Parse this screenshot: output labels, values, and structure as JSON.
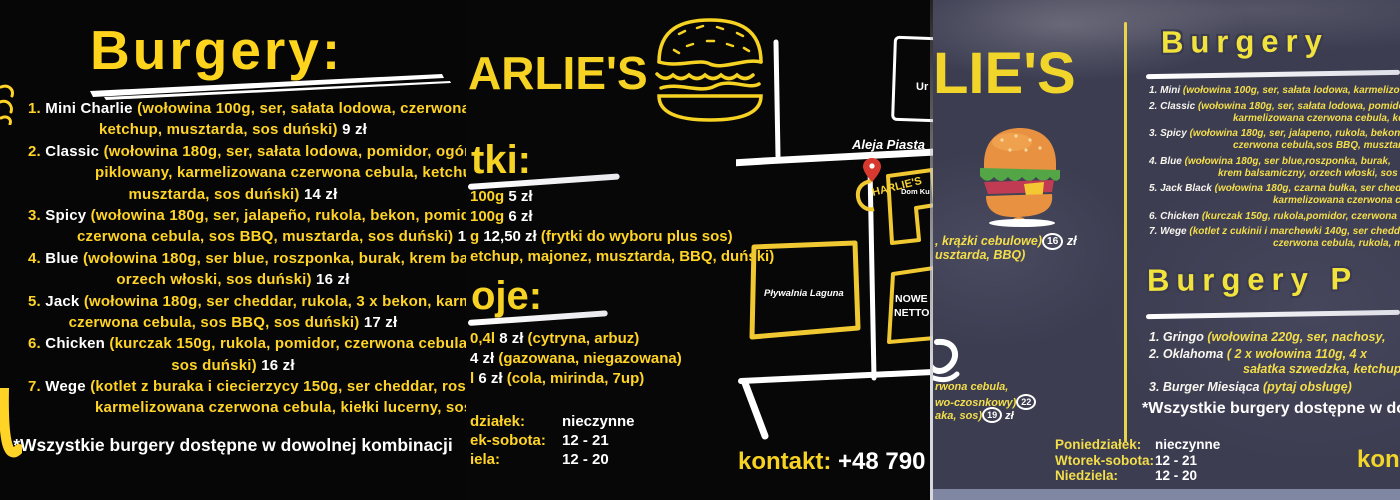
{
  "colors": {
    "yellow": "#ffd426",
    "yellow_soft": "#f3de4a",
    "white": "#ffffff",
    "black_bg": "#070707",
    "board_bg": "#3d3d52",
    "pin_red": "#d8392e"
  },
  "panel_left": {
    "title": "Burgery:",
    "lines": [
      {
        "cls": "start",
        "parts": [
          {
            "t": "1. ",
            "c": "n"
          },
          {
            "t": "Mini Charlie ",
            "c": "nm"
          },
          {
            "t": "(wołowina 100g, ser, sałata lodowa, czerwona",
            "c": "d"
          }
        ]
      },
      {
        "cls": "ctr",
        "parts": [
          {
            "t": "ketchup, musztarda, sos duński) ",
            "c": "d"
          },
          {
            "t": "9 zł",
            "c": "p"
          }
        ]
      },
      {
        "cls": "start",
        "parts": [
          {
            "t": "2. ",
            "c": "n"
          },
          {
            "t": "Classic ",
            "c": "nm"
          },
          {
            "t": "(wołowina  180g, ser, sałata lodowa, pomidor, ogórek",
            "c": "d"
          }
        ]
      },
      {
        "cls": "wrap",
        "parts": [
          {
            "t": "piklowany, karmelizowana czerwona cebula, ketchup,",
            "c": "d"
          }
        ]
      },
      {
        "cls": "ctr",
        "parts": [
          {
            "t": "musztarda, sos duński) ",
            "c": "d"
          },
          {
            "t": "14 zł",
            "c": "p"
          }
        ]
      },
      {
        "cls": "start",
        "parts": [
          {
            "t": "3. ",
            "c": "n"
          },
          {
            "t": "Spicy ",
            "c": "nm"
          },
          {
            "t": "(wołowina 180g, ser, jalapeño, rukola, bekon, pomidor,",
            "c": "d"
          }
        ]
      },
      {
        "cls": "wrap2",
        "parts": [
          {
            "t": "czerwona cebula, sos BBQ, musztarda, sos duński) ",
            "c": "d"
          },
          {
            "t": "1",
            "c": "p"
          }
        ]
      },
      {
        "cls": "start",
        "parts": [
          {
            "t": "4. ",
            "c": "n"
          },
          {
            "t": "Blue ",
            "c": "nm"
          },
          {
            "t": "(wołowina 180g, ser blue, roszponka, burak, krem balsamiczny,",
            "c": "d"
          }
        ]
      },
      {
        "cls": "ctr",
        "parts": [
          {
            "t": "orzech włoski, sos duński) ",
            "c": "d"
          },
          {
            "t": "16 zł",
            "c": "p"
          }
        ]
      },
      {
        "cls": "start",
        "parts": [
          {
            "t": "5. ",
            "c": "n"
          },
          {
            "t": "Jack ",
            "c": "nm"
          },
          {
            "t": "(wołowina 180g, ser cheddar, rukola, 3 x bekon, karmelizowana",
            "c": "d"
          }
        ]
      },
      {
        "cls": "ctr",
        "parts": [
          {
            "t": "czerwona cebula, sos BBQ, sos duński) ",
            "c": "d"
          },
          {
            "t": "17 zł",
            "c": "p"
          }
        ]
      },
      {
        "cls": "start",
        "parts": [
          {
            "t": "6. ",
            "c": "n"
          },
          {
            "t": "Chicken ",
            "c": "nm"
          },
          {
            "t": "(kurczak 150g, rukola, pomidor, czerwona cebula,",
            "c": "d"
          }
        ]
      },
      {
        "cls": "ctr",
        "parts": [
          {
            "t": "sos duński) ",
            "c": "d"
          },
          {
            "t": "16 zł",
            "c": "p"
          }
        ]
      },
      {
        "cls": "start",
        "parts": [
          {
            "t": "7. ",
            "c": "n"
          },
          {
            "t": "Wege ",
            "c": "nm"
          },
          {
            "t": "(kotlet z buraka i ciecierzycy 150g, ser cheddar, roszponka,",
            "c": "d"
          }
        ]
      },
      {
        "cls": "wrap",
        "parts": [
          {
            "t": "karmelizowana czerwona cebula, kiełki lucerny, sos duński)",
            "c": "d"
          }
        ]
      }
    ],
    "footer": "*Wszystkie burgery dostępne w dowolnej kombinacji"
  },
  "panel_middle": {
    "logo": "ARLIE'S",
    "fries_title": "tki:",
    "fries_lines": [
      {
        "cls": "edge",
        "parts": [
          {
            "t": "100g ",
            "c": "d"
          },
          {
            "t": "5 zł",
            "c": "p"
          }
        ]
      },
      {
        "cls": "edge",
        "parts": [
          {
            "t": "100g ",
            "c": "d"
          },
          {
            "t": "6 zł",
            "c": "p"
          }
        ]
      },
      {
        "cls": "edge",
        "parts": [
          {
            "t": "g ",
            "c": "d"
          },
          {
            "t": "12,50 zł ",
            "c": "p"
          },
          {
            "t": "(frytki do wyboru plus sos)",
            "c": "d"
          }
        ]
      },
      {
        "cls": "edge",
        "parts": [
          {
            "t": "etchup, majonez, musztarda, BBQ, duński)",
            "c": "d"
          }
        ]
      }
    ],
    "drinks_title": "oje:",
    "drinks_lines": [
      {
        "cls": "edge",
        "parts": [
          {
            "t": "0,4l ",
            "c": "d"
          },
          {
            "t": "8 zł ",
            "c": "p"
          },
          {
            "t": "(cytryna, arbuz)",
            "c": "d"
          }
        ]
      },
      {
        "cls": "edge",
        "parts": [
          {
            "t": "4 zł ",
            "c": "p"
          },
          {
            "t": "(gazowana, niegazowana)",
            "c": "d"
          }
        ]
      },
      {
        "cls": "edge",
        "parts": [
          {
            "t": "l ",
            "c": "d"
          },
          {
            "t": "6 zł ",
            "c": "p"
          },
          {
            "t": "(cola, mirinda, 7up)",
            "c": "d"
          }
        ]
      }
    ],
    "hours_lines": [
      {
        "cls": "edge",
        "parts": [
          {
            "t": "działek:",
            "c": "hl"
          },
          {
            "t": "nieczynne",
            "c": "hv"
          }
        ]
      },
      {
        "cls": "edge",
        "parts": [
          {
            "t": "ek-sobota:",
            "c": "hl"
          },
          {
            "t": "12 - 21",
            "c": "hv"
          }
        ]
      },
      {
        "cls": "edge",
        "parts": [
          {
            "t": "iela:",
            "c": "hl"
          },
          {
            "t": "12 - 20",
            "c": "hv"
          }
        ]
      }
    ],
    "contact_label": "kontakt: ",
    "contact_number": "+48 790",
    "map": {
      "street": "Aleja Piasta",
      "building_top": "Ur",
      "marker_label": "HARLIE'S",
      "building_dom": "Dom Ku",
      "building_pool": "Pływalnia Laguna",
      "building_netto_1": "NOWE",
      "building_netto_2": "NETTO"
    }
  },
  "panel_right": {
    "logo": "LIE'S",
    "left_lines_1": [
      {
        "cls": "edge",
        "parts": [
          {
            "t": ", krążki cebulowe)",
            "c": "d"
          },
          {
            "t": "16",
            "c": "circ"
          },
          {
            "t": " zł",
            "c": "w"
          }
        ]
      },
      {
        "cls": "edge",
        "parts": [
          {
            "t": "usztarda, BBQ)",
            "c": "d"
          }
        ]
      }
    ],
    "left_lines_2": [
      {
        "cls": "edge",
        "parts": [
          {
            "t": "rwona cebula,",
            "c": "d"
          }
        ]
      },
      {
        "cls": "edge",
        "parts": [
          {
            "t": "wo-czosnkowy)",
            "c": "d"
          },
          {
            "t": "22",
            "c": "circ"
          }
        ]
      },
      {
        "cls": "edge",
        "parts": [
          {
            "t": "aka, sos)",
            "c": "d"
          },
          {
            "t": "19",
            "c": "circ"
          },
          {
            "t": " zł",
            "c": "w"
          }
        ]
      }
    ],
    "section1_title": "Burgery",
    "section1_lines": [
      {
        "cls": "start",
        "parts": [
          {
            "t": "1. ",
            "c": "n"
          },
          {
            "t": "Mini ",
            "c": "nm"
          },
          {
            "t": "(wołowina 100g, ser, sałata lodowa, karmelizowana",
            "c": "d"
          }
        ]
      },
      {
        "cls": "start",
        "parts": [
          {
            "t": "2. ",
            "c": "n"
          },
          {
            "t": "Classic ",
            "c": "nm"
          },
          {
            "t": "(wołowina 180g, ser, sałata lodowa, pomidor,",
            "c": "d"
          }
        ]
      },
      {
        "cls": "wrap",
        "parts": [
          {
            "t": "karmelizowana czerwona cebula, ketchup,",
            "c": "d"
          }
        ]
      },
      {
        "cls": "start",
        "parts": [
          {
            "t": "3. ",
            "c": "n"
          },
          {
            "t": "Spicy ",
            "c": "nm"
          },
          {
            "t": "(wołowina 180g, ser, jalapeno, rukola, bekon,",
            "c": "d"
          }
        ]
      },
      {
        "cls": "wrap",
        "parts": [
          {
            "t": "czerwona cebula,sos BBQ, musztarda,",
            "c": "d"
          }
        ]
      },
      {
        "cls": "start",
        "parts": [
          {
            "t": "4. ",
            "c": "n"
          },
          {
            "t": "Blue ",
            "c": "nm"
          },
          {
            "t": "(wołowina 180g, ser blue,roszponka, burak,",
            "c": "d"
          }
        ]
      },
      {
        "cls": "wrap3",
        "parts": [
          {
            "t": "krem balsamiczny, orzech włoski, sos duński)",
            "c": "d"
          }
        ]
      },
      {
        "cls": "start",
        "parts": [
          {
            "t": "5. ",
            "c": "n"
          },
          {
            "t": "Jack Black ",
            "c": "nm"
          },
          {
            "t": "(wołowina 180g, czarna bułka, ser cheddar,",
            "c": "d"
          }
        ]
      },
      {
        "cls": "wrap4",
        "parts": [
          {
            "t": "karmelizowana czerwona cebula,",
            "c": "d"
          }
        ]
      },
      {
        "cls": "start",
        "parts": [
          {
            "t": "6. ",
            "c": "n"
          },
          {
            "t": "Chicken ",
            "c": "nm"
          },
          {
            "t": "(kurczak 150g, rukola,pomidor, czerwona",
            "c": "d"
          }
        ]
      },
      {
        "cls": "start",
        "parts": [
          {
            "t": "7. ",
            "c": "n"
          },
          {
            "t": "Wege ",
            "c": "nm"
          },
          {
            "t": "(kotlet z cukinii i marchewki 140g, ser cheddar,",
            "c": "d"
          }
        ]
      },
      {
        "cls": "wrap4",
        "parts": [
          {
            "t": "czerwona cebula, rukola, majonez,",
            "c": "d"
          }
        ]
      }
    ],
    "section2_title": "Burgery P",
    "section2_lines": [
      {
        "cls": "start",
        "parts": [
          {
            "t": "1. ",
            "c": "n"
          },
          {
            "t": "Gringo ",
            "c": "nm"
          },
          {
            "t": "(wołowina 220g, ser, nachosy,",
            "c": "d"
          }
        ]
      },
      {
        "cls": "start",
        "parts": [
          {
            "t": "2. ",
            "c": "n"
          },
          {
            "t": "Oklahoma ",
            "c": "nm"
          },
          {
            "t": "( 2 x wołowina 110g, 4 x",
            "c": "d"
          }
        ]
      },
      {
        "cls": "wrap",
        "parts": [
          {
            "t": "sałatka szwedzka, ketchup,",
            "c": "d"
          }
        ]
      },
      {
        "cls": "start",
        "parts": [
          {
            "t": "3. ",
            "c": "n"
          },
          {
            "t": "Burger Miesiąca ",
            "c": "nm"
          },
          {
            "t": "(pytaj obsługę)",
            "c": "d"
          }
        ]
      }
    ],
    "footer": "*Wszystkie burgery dostępne w dowolnej",
    "hours_lines": [
      {
        "cls": "edge",
        "parts": [
          {
            "t": "Poniedziałek:",
            "c": "hl"
          },
          {
            "t": "nieczynne",
            "c": "hv"
          }
        ]
      },
      {
        "cls": "edge",
        "parts": [
          {
            "t": "Wtorek-sobota:",
            "c": "hl"
          },
          {
            "t": "12 - 21",
            "c": "hv"
          }
        ]
      },
      {
        "cls": "edge",
        "parts": [
          {
            "t": "Niedziela:",
            "c": "hl"
          },
          {
            "t": "12 - 20",
            "c": "hv"
          }
        ]
      }
    ],
    "contact": "kont"
  }
}
